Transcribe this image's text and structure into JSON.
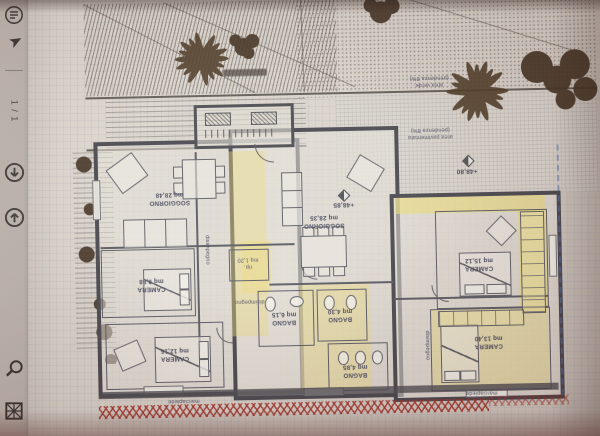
{
  "viewer": {
    "page_indicator": "1 / 1",
    "accent_colors": {
      "paper": "#d7d2cb",
      "toolbar": "#cbc4bf",
      "highlight": "#ecd874",
      "boundary_red": "#9e2c24",
      "wall": "#414149"
    }
  },
  "plan": {
    "rooms": {
      "soggiorno_left": "SOGGIORNO\nmq 28,48",
      "soggiorno_center": "SOGGIORNO\nmq 28,35",
      "camera_top_right": "CAMERA\nmq 15,12",
      "camera_bottom_right": "CAMERA\nmq 13,40",
      "camera_mid_left": "CAMERA\nmq 9,88",
      "camera_bottom_left": "CAMERA\nmq 12,16",
      "bagno_left": "BAGNO\nmq 6,15",
      "bagno_center": "BAGNO\nmq 4,30",
      "bagno_right": "BAGNO\nmq 4,85",
      "ripostiglio": "rip.\nmq 1,20",
      "disimpegno_left": "disimpegno",
      "disimpegno_center": "disimpegno",
      "disimpegno_right": "disimpegno"
    },
    "site": {
      "area_verde": "area verde\n(pendenza 8%)",
      "area_pavimentata": "area pavimentata\n(pendenza 8%)",
      "marciapiede_left": "marciapiede",
      "marciapiede_right": "marciapiede",
      "quota_centro": "+48,85",
      "quota_destra": "+48,80"
    }
  }
}
